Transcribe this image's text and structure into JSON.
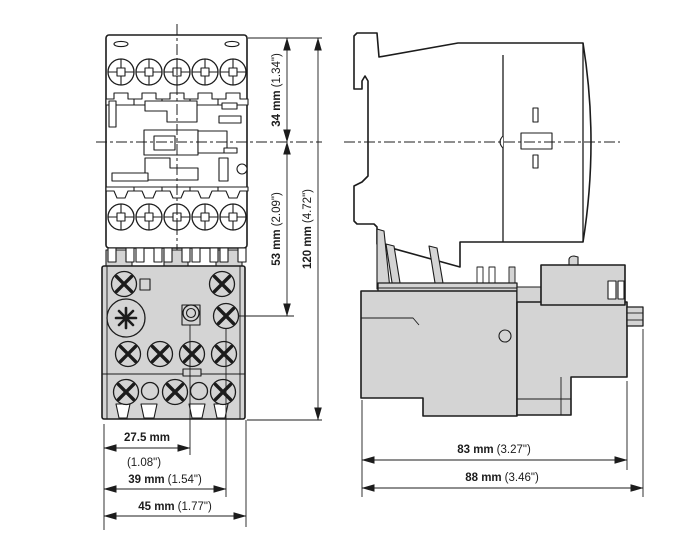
{
  "colors": {
    "line": "#1c1c1c",
    "gray": "#d4d4d4",
    "bg": "#ffffff"
  },
  "dims": {
    "h34": {
      "mm": "34 mm",
      "in": "(1.34\")"
    },
    "h53": {
      "mm": "53 mm",
      "in": "(2.09\")"
    },
    "h120": {
      "mm": "120 mm",
      "in": "(4.72\")"
    },
    "w27_5": {
      "mm": "27.5 mm",
      "in": "(1.08\")"
    },
    "w39": {
      "mm": "39 mm",
      "in": "(1.54\")"
    },
    "w45": {
      "mm": "45 mm",
      "in": "(1.77\")"
    },
    "d83": {
      "mm": "83 mm",
      "in": "(3.27\")"
    },
    "d88": {
      "mm": "88 mm",
      "in": "(3.46\")"
    }
  }
}
